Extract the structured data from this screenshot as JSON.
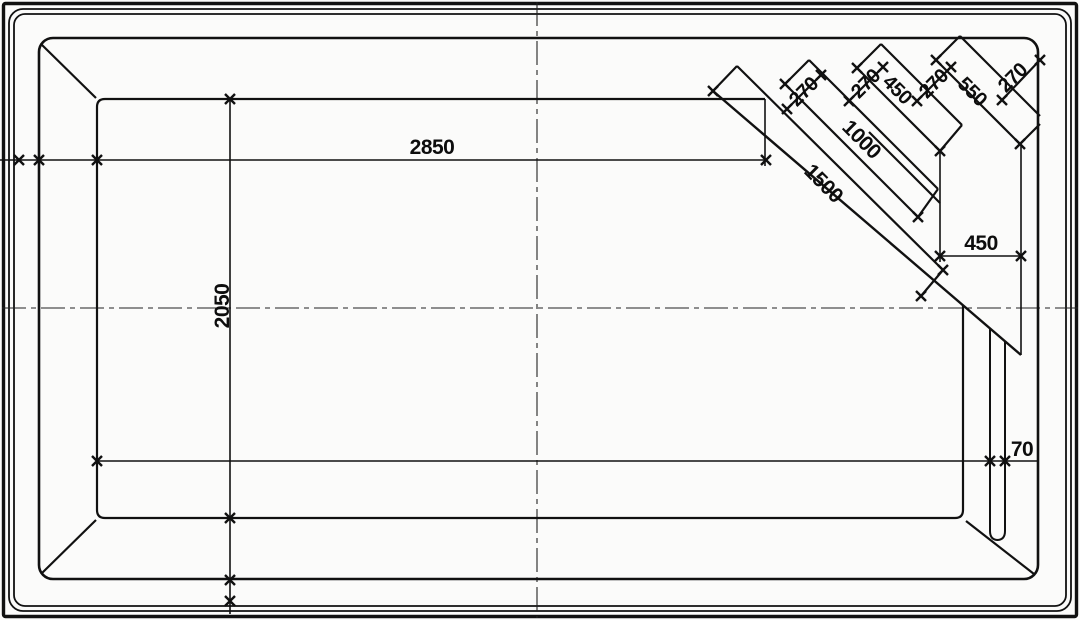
{
  "drawing": {
    "dimensions": {
      "pool_length": "2850",
      "pool_width": "2050",
      "stair_edge_long": "1500",
      "stair_edge_mid": "1000",
      "stair_edge_short": "450",
      "stair_edge_top": "550",
      "stair_tread_1": "270",
      "stair_tread_2": "270",
      "stair_tread_3": "270",
      "stair_tread_4": "270",
      "stair_side_width": "450",
      "wall_lip": "70"
    }
  }
}
